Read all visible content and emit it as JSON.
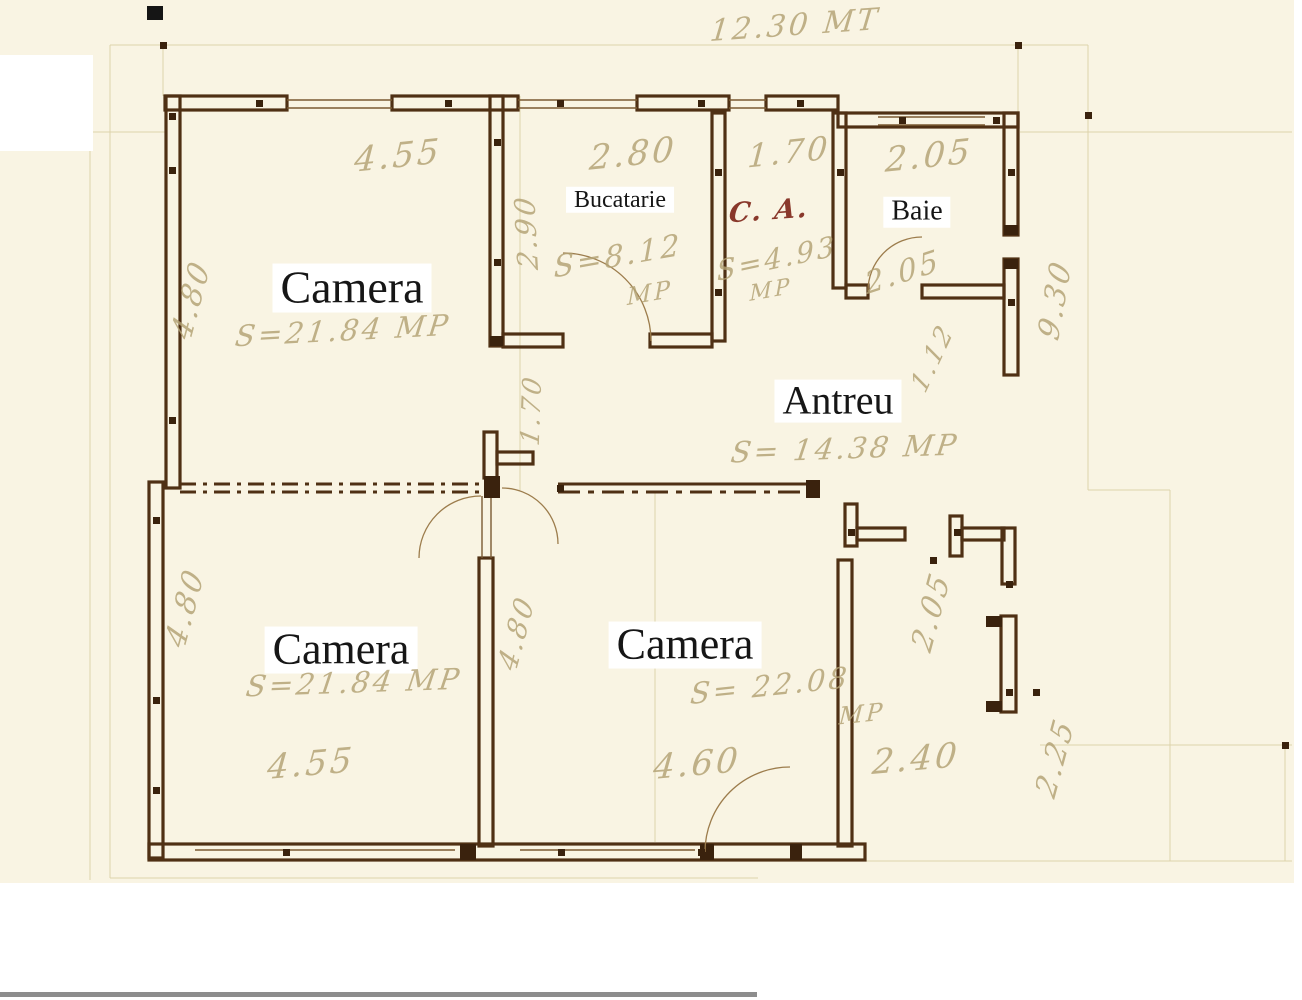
{
  "document_type": "floor-plan-scan",
  "rooms": [
    {
      "label": "Camera",
      "area": "S=21.84 MP"
    },
    {
      "label": "Bucatarie",
      "area": "S=8.12",
      "unit": "MP"
    },
    {
      "label": "C. A.",
      "area": "S=4.93",
      "unit": "MP"
    },
    {
      "label": "Baie"
    },
    {
      "label": "Antreu",
      "area": "S= 14.38 MP"
    },
    {
      "label": "Camera",
      "area": "S=21.84 MP"
    },
    {
      "label": "Camera",
      "area": "S= 22.08",
      "unit": "MP"
    }
  ],
  "dimensions": {
    "overall_top": "12.30 MT",
    "top_row": [
      "4.55",
      "2.80",
      "1.70",
      "2.05"
    ],
    "bottom_row": [
      "4.55",
      "4.60",
      "2.40"
    ],
    "left_col": [
      "4.80",
      "4.80"
    ],
    "right_col": [
      "9.30",
      "2.05",
      "2.25"
    ],
    "inner": [
      "2.90",
      "1.70",
      "4.80",
      "1.12",
      "2.05"
    ]
  },
  "colors": {
    "paper": "#f9f4e3",
    "wall_ink": "#4f3014",
    "pencil_ink": "#b3a274",
    "red_ink": "#7d2418"
  }
}
